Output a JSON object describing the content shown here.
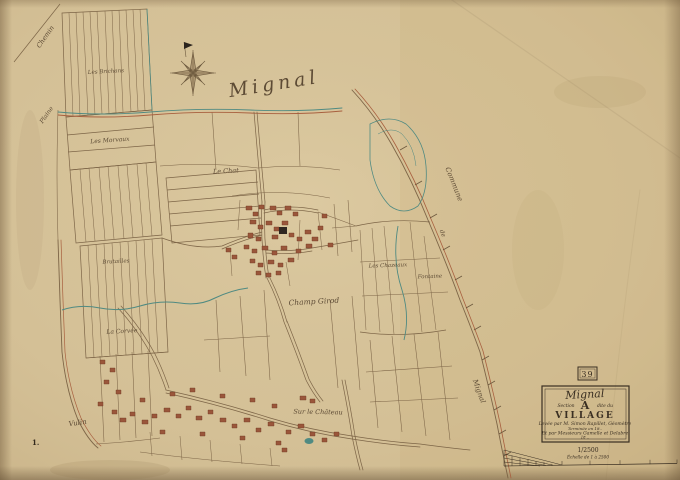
{
  "map": {
    "territory_label": "Mignal",
    "sheet_corner_number": "1.",
    "edge_labels": {
      "top_left": "Chemin",
      "left": "Plaine",
      "bottom_left": "Vulin",
      "right_commune": "Commune",
      "right_de": "de",
      "right_name": "Mignal"
    },
    "lieux_dits": [
      {
        "name": "Les Brichans"
      },
      {
        "name": "Les Morvaux"
      },
      {
        "name": "Le Chat"
      },
      {
        "name": "Brutailles"
      },
      {
        "name": "La Corvée"
      },
      {
        "name": "Champ Girod"
      },
      {
        "name": "Les Chazeaux"
      },
      {
        "name": "Fontaine"
      },
      {
        "name": "Sur le Château"
      }
    ],
    "icons": {
      "compass_rose": "eight-point-compass-star",
      "north_pennant": "north-pennant-flag"
    }
  },
  "cartouche": {
    "plate_number": "39",
    "title_commune": "Mignal",
    "section_prefix": "Section",
    "section_letter": "A",
    "section_suffix": "dite du",
    "section_name": "VILLAGE",
    "credit_line_1": "Levée par M. Simon Rapillet, Géomètre",
    "credit_line_2": "Terminée en 18..",
    "credit_line_3": "Et par Messieurs Gamelle et Delabre",
    "credit_line_4": "18 ..",
    "scale_ratio": "1/2500",
    "scale_caption": "Échelle de 1 à 2500"
  },
  "colors": {
    "paper": "#d4c096",
    "ink_sepia": "#7d6547",
    "ink_dark": "#3a2f22",
    "water_teal": "#4f8a82",
    "building_carmine": "#9a563a",
    "road_red": "#a8603f"
  }
}
